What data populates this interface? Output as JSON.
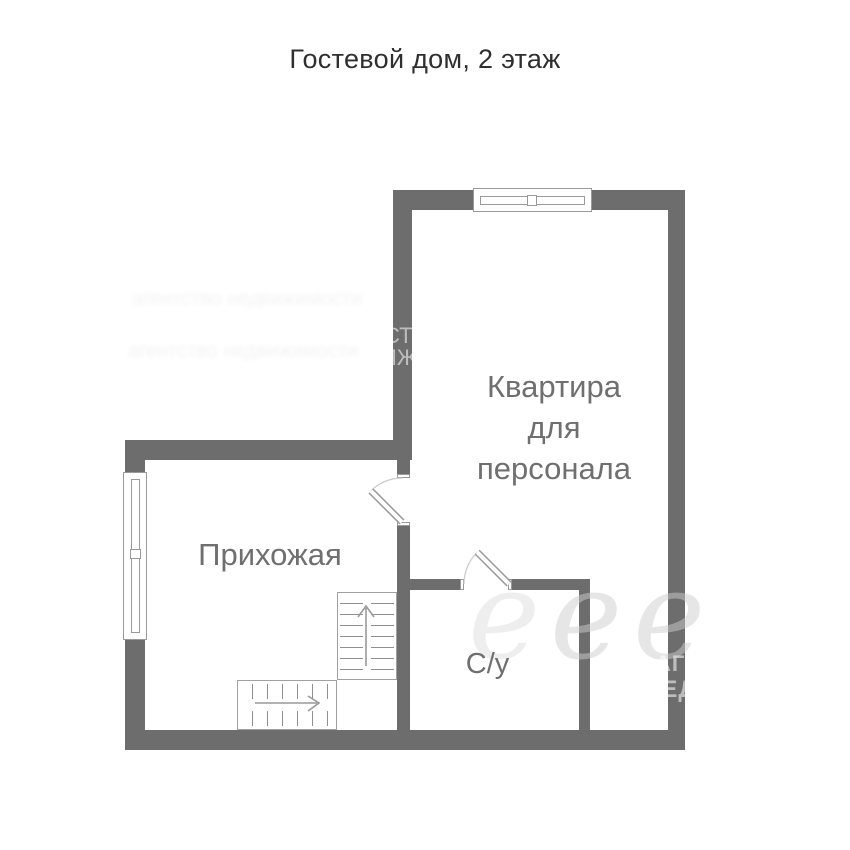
{
  "title": "Гостевой дом, 2 этаж",
  "rooms": {
    "apartment": "Квартира\nдля\nперсонала",
    "hallway": "Прихожая",
    "bathroom": "С/у"
  },
  "watermark": {
    "blur_line_1": "агентство недвижимости",
    "blur_line_2": "агентство недвижимости",
    "wall_fragment_top": "СТ",
    "wall_fragment_bottom": "ИЖ",
    "right_fragment_top": "АГЕ",
    "right_fragment_bottom": "НЕД",
    "script_letter": "е"
  },
  "colors": {
    "wall": "#6d6d6d",
    "line": "#9a9a9a",
    "tread": "#8f8f8f",
    "label": "#6f6f6f",
    "title": "#2f2f2f"
  }
}
